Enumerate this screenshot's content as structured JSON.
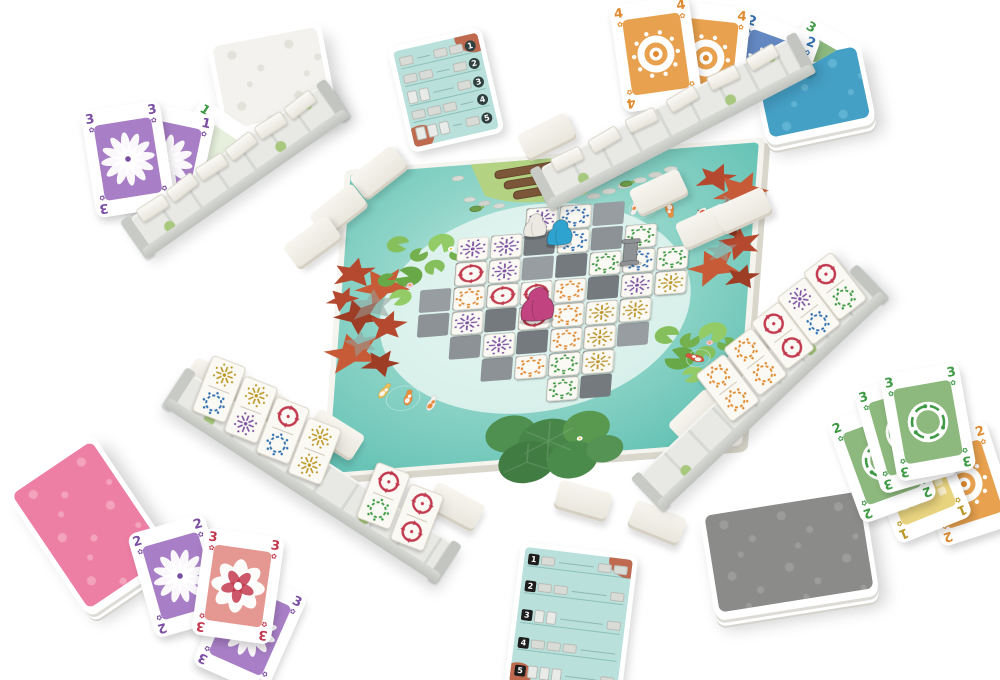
{
  "scene": {
    "width": 1000,
    "height": 680,
    "background": "#ffffff"
  },
  "suits": {
    "blue": {
      "hex": "#2f6fb0",
      "motif": "ring",
      "art_bg": "#6488c2"
    },
    "green": {
      "hex": "#3e9a44",
      "motif": "ring",
      "art_bg": "#8db97e"
    },
    "orange": {
      "hex": "#df8a2e",
      "motif": "ring",
      "art_bg": "#e8a14e"
    },
    "red": {
      "hex": "#c23a4f",
      "motif": "pinwheel",
      "art_bg": "#e59892"
    },
    "purple": {
      "hex": "#7b4fa3",
      "motif": "burst",
      "art_bg": "#a87fc6"
    },
    "yellow": {
      "hex": "#bb9622",
      "motif": "burst",
      "art_bg": "#e8d37f"
    }
  },
  "board": {
    "transform": [
      0.84,
      -0.065,
      -0.046,
      0.616,
      345,
      170
    ],
    "palette": {
      "edge": "#f6f4ee",
      "water_deep": "#5fc0b2",
      "water_mid": "#93d6ca",
      "water_light": "#cdeee8",
      "tile_face": "#fbf9f4",
      "stone_shades": [
        "#8d9296",
        "#7e8387",
        "#747a7e",
        "#979da0"
      ],
      "grass": "#b3d383",
      "log": "#7c5638",
      "autumn": "#b5492f",
      "lotus": "#478548"
    },
    "path": {
      "origin": [
        100,
        85
      ],
      "cell": 40,
      "rows": [
        {
          "r": 0,
          "c": [
            3,
            4,
            5
          ]
        },
        {
          "r": 1,
          "c": [
            2,
            3,
            4,
            5,
            6
          ]
        },
        {
          "r": 2,
          "c": [
            1,
            2,
            3,
            4,
            5,
            6,
            7
          ]
        },
        {
          "r": 3,
          "c": [
            0,
            1,
            2,
            3,
            4,
            5,
            6,
            7
          ]
        },
        {
          "r": 4,
          "c": [
            0,
            1,
            2,
            3,
            4,
            5,
            6
          ]
        },
        {
          "r": 5,
          "c": [
            1,
            2,
            3,
            4,
            5,
            6
          ]
        },
        {
          "r": 6,
          "c": [
            2,
            3,
            4,
            5
          ]
        },
        {
          "r": 7,
          "c": [
            4,
            5
          ]
        }
      ]
    },
    "tiles": [
      {
        "c": 3,
        "r": 0,
        "s": "purple"
      },
      {
        "c": 4,
        "r": 0,
        "s": "blue"
      },
      {
        "c": 1,
        "r": 1,
        "s": "purple"
      },
      {
        "c": 2,
        "r": 1,
        "s": "purple"
      },
      {
        "c": 4,
        "r": 1,
        "s": "blue"
      },
      {
        "c": 6,
        "r": 1,
        "s": "green"
      },
      {
        "c": 1,
        "r": 2,
        "s": "red"
      },
      {
        "c": 2,
        "r": 2,
        "s": "purple"
      },
      {
        "c": 5,
        "r": 2,
        "s": "green"
      },
      {
        "c": 6,
        "r": 2,
        "s": "blue"
      },
      {
        "c": 7,
        "r": 2,
        "s": "green"
      },
      {
        "c": 1,
        "r": 3,
        "s": "orange"
      },
      {
        "c": 2,
        "r": 3,
        "s": "red"
      },
      {
        "c": 3,
        "r": 3,
        "s": "red"
      },
      {
        "c": 4,
        "r": 3,
        "s": "orange"
      },
      {
        "c": 6,
        "r": 3,
        "s": "purple"
      },
      {
        "c": 7,
        "r": 3,
        "s": "yellow"
      },
      {
        "c": 1,
        "r": 4,
        "s": "purple"
      },
      {
        "c": 3,
        "r": 4,
        "s": "red"
      },
      {
        "c": 4,
        "r": 4,
        "s": "orange"
      },
      {
        "c": 5,
        "r": 4,
        "s": "yellow"
      },
      {
        "c": 6,
        "r": 4,
        "s": "yellow"
      },
      {
        "c": 2,
        "r": 5,
        "s": "purple"
      },
      {
        "c": 4,
        "r": 5,
        "s": "orange"
      },
      {
        "c": 5,
        "r": 5,
        "s": "yellow"
      },
      {
        "c": 3,
        "r": 6,
        "s": "orange"
      },
      {
        "c": 4,
        "r": 6,
        "s": "green"
      },
      {
        "c": 5,
        "r": 6,
        "s": "yellow"
      },
      {
        "c": 4,
        "r": 7,
        "s": "green"
      }
    ],
    "pawns": [
      {
        "name": "white-pawn",
        "hex": "#ece9e2",
        "x": 233,
        "y": 116,
        "s": 1.0,
        "type": "robe"
      },
      {
        "name": "blue-pawn",
        "hex": "#2fa3cf",
        "x": 263,
        "y": 131,
        "s": 1.1,
        "type": "robe"
      },
      {
        "name": "gray-statue-pawn",
        "hex": "#8f9294",
        "x": 349,
        "y": 172,
        "s": 1.05,
        "type": "statue"
      },
      {
        "name": "magenta-pawn",
        "hex": "#c14480",
        "x": 243,
        "y": 246,
        "s": 1.45,
        "type": "robe"
      }
    ],
    "koi": [
      {
        "x": 352,
        "y": 95,
        "rot": 15,
        "main": "#f1f0ec",
        "patch": "#e8893c"
      },
      {
        "x": 392,
        "y": 104,
        "rot": -12,
        "main": "#eb8d3f",
        "patch": "#f6f5f1"
      },
      {
        "x": 430,
        "y": 116,
        "rot": 28,
        "main": "#f1f0ec",
        "patch": "#d9533d"
      },
      {
        "x": 66,
        "y": 368,
        "rot": 205,
        "main": "#e8c05a",
        "patch": "#f6f5f1"
      },
      {
        "x": 96,
        "y": 382,
        "rot": 185,
        "main": "#eb8d3f",
        "patch": "#f6f5f1"
      },
      {
        "x": 124,
        "y": 394,
        "rot": 195,
        "main": "#f1f0ec",
        "patch": "#e8893c"
      },
      {
        "x": 438,
        "y": 352,
        "rot": 120,
        "main": "#d9533d",
        "patch": "#f6f5f1"
      }
    ]
  },
  "decks": [
    {
      "id": "white-deck",
      "color_name": "white",
      "x": 214,
      "y": 31,
      "w": 116,
      "h": 94,
      "rot": -11,
      "z": 2,
      "back": "#f3f2ee",
      "pattern": "#e2e1da"
    },
    {
      "id": "blue-deck",
      "color_name": "blue",
      "x": 757,
      "y": 51,
      "w": 112,
      "h": 82,
      "rot": -12,
      "z": 2,
      "back": "#45a0c6",
      "pattern": "#60b3d3"
    },
    {
      "id": "pink-deck",
      "color_name": "pink",
      "x": 37,
      "y": 451,
      "w": 106,
      "h": 148,
      "rot": -34,
      "z": 5,
      "back": "#ee7fa4",
      "pattern": "#f4a3bd"
    },
    {
      "id": "gray-deck",
      "color_name": "gray",
      "x": 706,
      "y": 498,
      "w": 166,
      "h": 108,
      "rot": -9,
      "z": 5,
      "back": "#8b8b89",
      "pattern": "#9c9c9a"
    }
  ],
  "racks": [
    {
      "id": "tile-rack-top-left",
      "x": 150,
      "y": 246,
      "len": 228,
      "angle": -35,
      "tilt": 0,
      "backs": [
        8,
        44,
        80,
        116,
        152,
        188
      ],
      "tiles": []
    },
    {
      "id": "tile-rack-top-right",
      "x": 556,
      "y": 198,
      "len": 278,
      "angle": -27.5,
      "tilt": 0,
      "backs": [
        12,
        54,
        96,
        142,
        188,
        232
      ],
      "tiles": []
    },
    {
      "id": "tile-rack-bottom-left",
      "x": 176,
      "y": 404,
      "len": 306,
      "angle": 33,
      "tilt": -12,
      "backs": [],
      "tiles": [
        {
          "o": 10,
          "s": [
            "yellow",
            "blue"
          ]
        },
        {
          "o": 48,
          "s": [
            "yellow",
            "purple"
          ]
        },
        {
          "o": 86,
          "s": [
            "red",
            "blue"
          ]
        },
        {
          "o": 124,
          "s": [
            "yellow",
            "yellow"
          ]
        },
        {
          "o": 206,
          "s": [
            "red",
            "green"
          ]
        },
        {
          "o": 246,
          "s": [
            "red",
            "red"
          ]
        }
      ]
    },
    {
      "id": "tile-rack-right",
      "x": 664,
      "y": 498,
      "len": 290,
      "angle": -43.5,
      "tilt": 6,
      "backs": [],
      "tiles": [
        {
          "o": 104,
          "s": [
            "orange",
            "orange"
          ]
        },
        {
          "o": 142,
          "s": [
            "orange",
            "orange"
          ]
        },
        {
          "o": 180,
          "s": [
            "red",
            "red"
          ]
        },
        {
          "o": 216,
          "s": [
            "purple",
            "blue"
          ]
        },
        {
          "o": 252,
          "s": [
            "red",
            "green"
          ]
        }
      ]
    }
  ],
  "fans": [
    {
      "id": "hand-top-left",
      "x": 88,
      "y": 105,
      "z": 2,
      "clip": "polygon(-30px -30px, 280px -30px, 280px -20px, -30px 198px)",
      "cards": [
        {
          "value": "1",
          "suit": "green",
          "art": "tool",
          "pip": "↓",
          "bg": "#e7f0dd",
          "dx": 78,
          "dy": 6,
          "rot": 34
        },
        {
          "value": "1",
          "suit": "purple",
          "art": "rosette",
          "pip": "✿",
          "dx": 38,
          "dy": 2,
          "rot": 12
        },
        {
          "value": "3",
          "suit": "purple",
          "art": "rosette",
          "pip": "✿",
          "dx": 0,
          "dy": 0,
          "rot": -9
        }
      ]
    },
    {
      "id": "hand-top-right",
      "x": 608,
      "y": 0,
      "z": 2,
      "clip": "polygon(-30px -40px, 330px -40px, 330px -9px, -30px 201px)",
      "cards": [
        {
          "value": "3",
          "suit": "green",
          "art": "koi",
          "pip": "✿",
          "dx": 168,
          "dy": 28,
          "rot": 30
        },
        {
          "value": "2",
          "suit": "blue",
          "art": "daisy",
          "pip": "✿",
          "dx": 118,
          "dy": 20,
          "rot": 20
        },
        {
          "value": "4",
          "suit": "orange",
          "art": "mandala",
          "pip": "✿",
          "dx": 58,
          "dy": 4,
          "rot": 6
        },
        {
          "value": "4",
          "suit": "orange",
          "art": "mandala",
          "pip": "✿",
          "dx": 8,
          "dy": 0,
          "rot": -8
        }
      ]
    },
    {
      "id": "hand-bottom-left",
      "x": 140,
      "y": 520,
      "z": 6,
      "clip": "",
      "cards": [
        {
          "value": "3",
          "suit": "purple",
          "art": "rosette",
          "pip": "✿",
          "dx": 70,
          "dy": 56,
          "rot": 24
        },
        {
          "value": "2",
          "suit": "purple",
          "art": "rosette",
          "pip": "✿",
          "dx": 0,
          "dy": 2,
          "rot": -16
        },
        {
          "value": "3",
          "suit": "red",
          "art": "peony",
          "pip": "✿",
          "dx": 58,
          "dy": 12,
          "rot": 8
        }
      ]
    },
    {
      "id": "hand-right",
      "x": 836,
      "y": 368,
      "z": 6,
      "clip": "",
      "cards": [
        {
          "value": "2",
          "suit": "orange",
          "art": "mandala",
          "pip": "✿",
          "dx": 88,
          "dy": 62,
          "rot": -18
        },
        {
          "value": "1",
          "suit": "yellow",
          "art": "mosaic",
          "pip": "✿",
          "dx": 40,
          "dy": 58,
          "rot": -22
        },
        {
          "value": "2",
          "suit": "green",
          "art": "koi",
          "pip": "✿",
          "dx": 6,
          "dy": 38,
          "rot": -20
        },
        {
          "value": "3",
          "suit": "green",
          "art": "koi",
          "pip": "✿",
          "dx": 30,
          "dy": 10,
          "rot": -16
        },
        {
          "value": "3",
          "suit": "green",
          "art": "koi",
          "pip": "✿",
          "dx": 52,
          "dy": 0,
          "rot": -10
        }
      ]
    }
  ],
  "blank_tiles": [
    {
      "x": 352,
      "y": 158,
      "rot": -38
    },
    {
      "x": 312,
      "y": 196,
      "rot": -38
    },
    {
      "x": 286,
      "y": 228,
      "rot": -36
    },
    {
      "x": 520,
      "y": 122,
      "rot": -26
    },
    {
      "x": 572,
      "y": 150,
      "rot": -26
    },
    {
      "x": 632,
      "y": 178,
      "rot": -25
    },
    {
      "x": 678,
      "y": 212,
      "rot": -24
    },
    {
      "x": 716,
      "y": 196,
      "rot": -24
    },
    {
      "x": 752,
      "y": 306,
      "rot": -44
    },
    {
      "x": 714,
      "y": 350,
      "rot": -44
    },
    {
      "x": 670,
      "y": 402,
      "rot": -44
    },
    {
      "x": 186,
      "y": 368,
      "rot": 32
    },
    {
      "x": 236,
      "y": 386,
      "rot": 32
    },
    {
      "x": 308,
      "y": 420,
      "rot": 32
    },
    {
      "x": 428,
      "y": 492,
      "rot": 28
    },
    {
      "x": 556,
      "y": 486,
      "rot": 16
    },
    {
      "x": 630,
      "y": 508,
      "rot": 22
    }
  ],
  "reference_cards": [
    {
      "id": "reference-card-top",
      "x": 398,
      "y": 36,
      "w": 78,
      "h": 88,
      "rot": -13,
      "badge_side": "right",
      "rows": [
        "1",
        "2",
        "3",
        "4",
        "5"
      ]
    },
    {
      "id": "reference-card-bottom",
      "x": 512,
      "y": 548,
      "w": 100,
      "h": 126,
      "rot": 7,
      "badge_side": "left",
      "rows": [
        "1",
        "2",
        "3",
        "4",
        "5"
      ]
    }
  ]
}
